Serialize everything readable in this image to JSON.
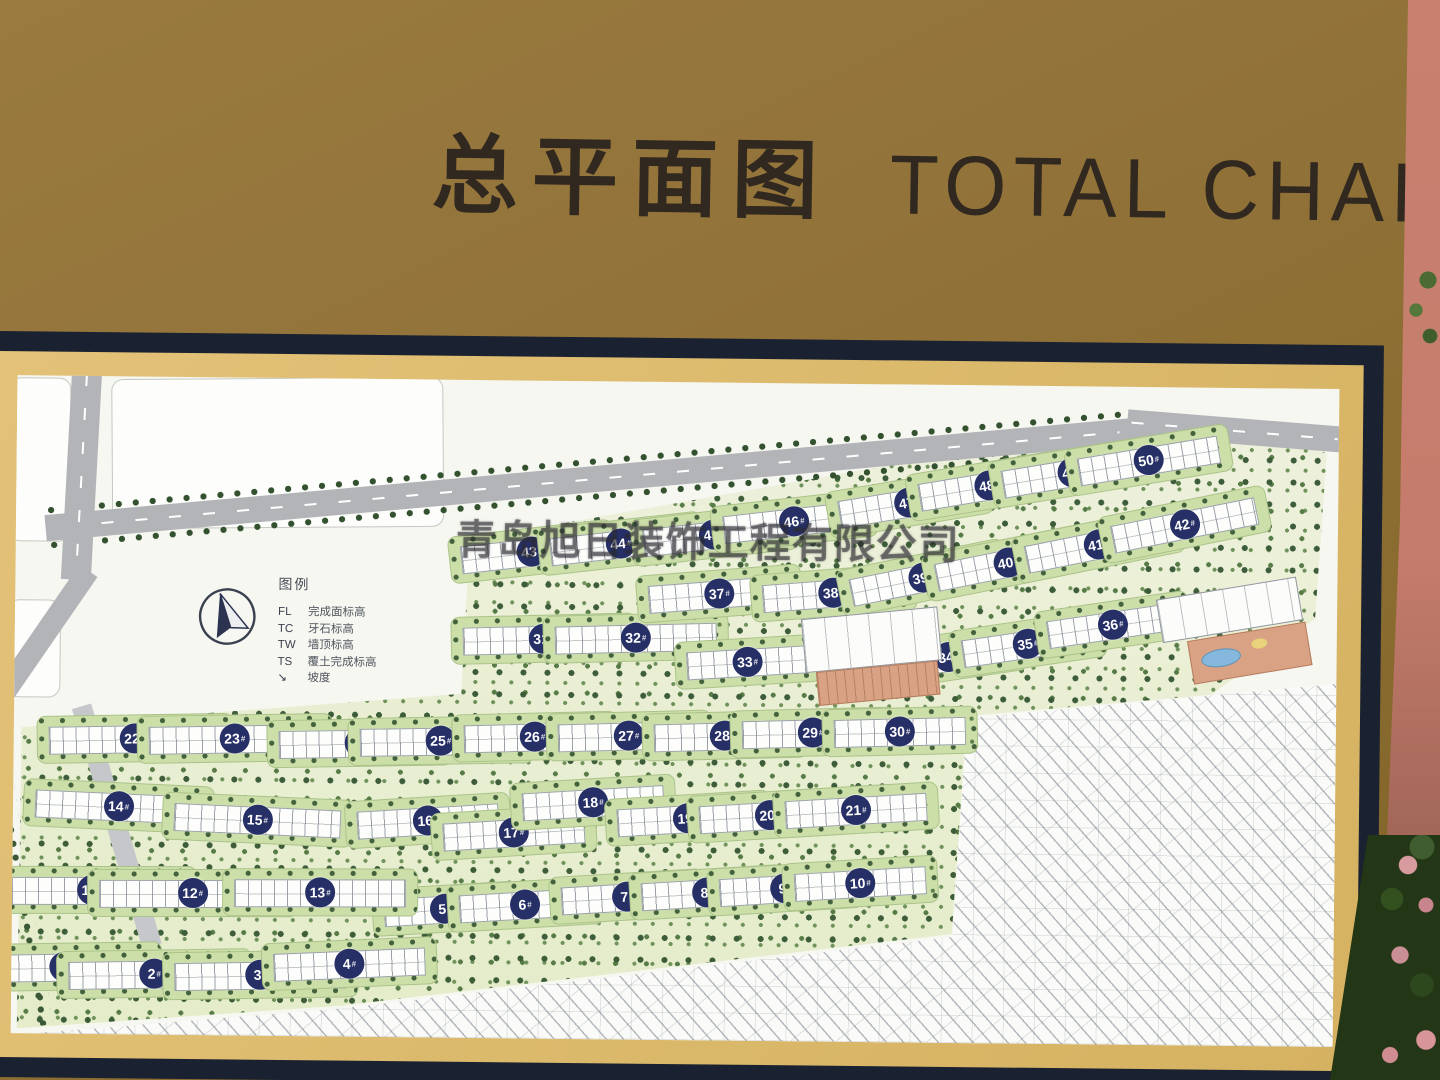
{
  "header": {
    "title_cn": "总平面图",
    "title_en": "TOTAL CHART"
  },
  "watermark": {
    "text": "青岛旭日装饰工程有限公司"
  },
  "legend": {
    "title": "图例",
    "items": [
      {
        "abbr": "FL",
        "label": "完成面标高"
      },
      {
        "abbr": "TC",
        "label": "牙石标高"
      },
      {
        "abbr": "TW",
        "label": "墙顶标高"
      },
      {
        "abbr": "TS",
        "label": "覆土完成标高"
      },
      {
        "abbr": "↘",
        "label": "坡度"
      }
    ]
  },
  "colors": {
    "sign_gold": "#92733a",
    "frame_navy": "#1a2130",
    "mat_gold": "#d9b86a",
    "map_background": "#f6f7f1",
    "road_gray": "#b3b4b8",
    "marker_navy": "#273066",
    "lawn_green": "#cddfa9",
    "tree_green": "#3d5c39",
    "wall_red": "#c57c6c",
    "facility_salmon": "#d9a284",
    "pool_blue": "#85b8dc"
  },
  "map": {
    "marker_suffix": "#",
    "buildings": [
      {
        "n": 1,
        "x": 53,
        "y": 591,
        "w": 170,
        "a": -1.5
      },
      {
        "n": 2,
        "x": 143,
        "y": 597,
        "w": 170,
        "a": -1.5
      },
      {
        "n": 3,
        "x": 249,
        "y": 597,
        "w": 170,
        "a": -1.5
      },
      {
        "n": 4,
        "x": 338,
        "y": 585,
        "w": 150,
        "a": -3
      },
      {
        "n": 5,
        "x": 433,
        "y": 529,
        "w": 120,
        "a": -4
      },
      {
        "n": 6,
        "x": 513,
        "y": 524,
        "w": 130,
        "a": -4
      },
      {
        "n": 7,
        "x": 615,
        "y": 515,
        "w": 130,
        "a": -4
      },
      {
        "n": 8,
        "x": 695,
        "y": 510,
        "w": 130,
        "a": -4
      },
      {
        "n": 9,
        "x": 773,
        "y": 505,
        "w": 130,
        "a": -4
      },
      {
        "n": 10,
        "x": 848,
        "y": 499,
        "w": 130,
        "a": -4
      },
      {
        "n": 11,
        "x": 79,
        "y": 514,
        "w": 185,
        "a": -0.5
      },
      {
        "n": 12,
        "x": 180,
        "y": 516,
        "w": 185,
        "a": -0.5
      },
      {
        "n": 13,
        "x": 308,
        "y": 514,
        "w": 170,
        "a": -0.5
      },
      {
        "n": 14,
        "x": 105,
        "y": 430,
        "w": 165,
        "a": 2
      },
      {
        "n": 15,
        "x": 244,
        "y": 442,
        "w": 165,
        "a": 2
      },
      {
        "n": 16,
        "x": 415,
        "y": 441,
        "w": 140,
        "a": -4
      },
      {
        "n": 17,
        "x": 501,
        "y": 452,
        "w": 140,
        "a": -4
      },
      {
        "n": 18,
        "x": 580,
        "y": 421,
        "w": 140,
        "a": -4
      },
      {
        "n": 19,
        "x": 675,
        "y": 436,
        "w": 140,
        "a": -4
      },
      {
        "n": 20,
        "x": 757,
        "y": 432,
        "w": 140,
        "a": -4
      },
      {
        "n": 21,
        "x": 843,
        "y": 426,
        "w": 140,
        "a": -4
      },
      {
        "n": 22,
        "x": 121,
        "y": 362,
        "w": 170,
        "a": -1.5
      },
      {
        "n": 23,
        "x": 221,
        "y": 361,
        "w": 170,
        "a": -1.5
      },
      {
        "n": 24,
        "x": 346,
        "y": 364,
        "w": 160,
        "a": -1.5
      },
      {
        "n": 25,
        "x": 427,
        "y": 361,
        "w": 160,
        "a": -1.5
      },
      {
        "n": 26,
        "x": 521,
        "y": 356,
        "w": 140,
        "a": -2
      },
      {
        "n": 27,
        "x": 615,
        "y": 354,
        "w": 140,
        "a": -2
      },
      {
        "n": 28,
        "x": 711,
        "y": 353,
        "w": 140,
        "a": -2
      },
      {
        "n": 29,
        "x": 799,
        "y": 349,
        "w": 140,
        "a": -2
      },
      {
        "n": 30,
        "x": 886,
        "y": 347,
        "w": 130,
        "a": -2
      },
      {
        "n": 31,
        "x": 529,
        "y": 258,
        "w": 160,
        "a": -2
      },
      {
        "n": 32,
        "x": 621,
        "y": 256,
        "w": 160,
        "a": -2
      },
      {
        "n": 33,
        "x": 733,
        "y": 279,
        "w": 120,
        "a": -4
      },
      {
        "n": 34,
        "x": 934,
        "y": 272,
        "w": 130,
        "a": -9
      },
      {
        "n": 35,
        "x": 1013,
        "y": 258,
        "w": 130,
        "a": -9
      },
      {
        "n": 36,
        "x": 1098,
        "y": 238,
        "w": 130,
        "a": -9
      },
      {
        "n": 37,
        "x": 704,
        "y": 211,
        "w": 140,
        "a": -5
      },
      {
        "n": 38,
        "x": 818,
        "y": 209,
        "w": 140,
        "a": -5
      },
      {
        "n": 39,
        "x": 907,
        "y": 193,
        "w": 145,
        "a": -12
      },
      {
        "n": 40,
        "x": 992,
        "y": 177,
        "w": 145,
        "a": -12
      },
      {
        "n": 41,
        "x": 1082,
        "y": 158,
        "w": 145,
        "a": -12
      },
      {
        "n": 42,
        "x": 1168,
        "y": 137,
        "w": 145,
        "a": -12
      },
      {
        "n": 43,
        "x": 516,
        "y": 171,
        "w": 140,
        "a": -7
      },
      {
        "n": 44,
        "x": 605,
        "y": 162,
        "w": 140,
        "a": -7
      },
      {
        "n": 45,
        "x": 698,
        "y": 152,
        "w": 140,
        "a": -7
      },
      {
        "n": 46,
        "x": 778,
        "y": 138,
        "w": 140,
        "a": -7
      },
      {
        "n": 47,
        "x": 893,
        "y": 118,
        "w": 140,
        "a": -10
      },
      {
        "n": 48,
        "x": 973,
        "y": 100,
        "w": 140,
        "a": -10
      },
      {
        "n": 49,
        "x": 1056,
        "y": 86,
        "w": 140,
        "a": -10
      },
      {
        "n": 50,
        "x": 1132,
        "y": 73,
        "w": 140,
        "a": -10
      }
    ]
  }
}
